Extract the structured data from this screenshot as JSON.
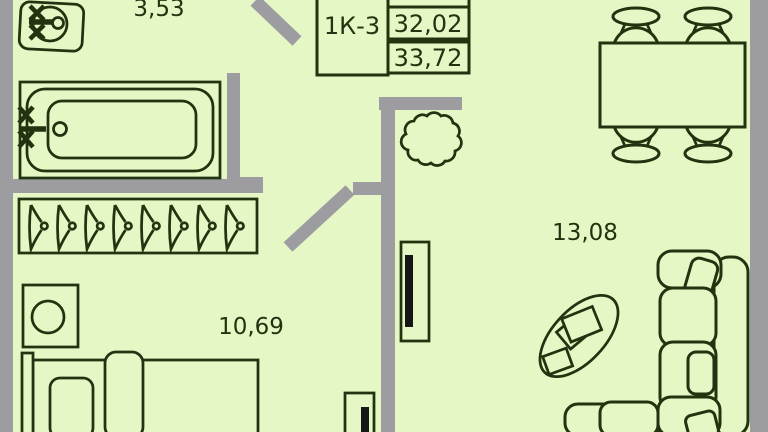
{
  "plan": {
    "unit_table": {
      "unit_type": "1К-3",
      "value_top": "32,02",
      "value_bottom": "33,72"
    },
    "rooms": {
      "bathroom": {
        "area": "3,53"
      },
      "bedroom": {
        "area": "10,69"
      },
      "living_room": {
        "area": "13,08"
      }
    },
    "colors": {
      "floor": "#e6f7c6",
      "wall": "#9d9da1",
      "line": "#22330f",
      "shaft": "#161616"
    },
    "icons": [
      "sink-icon",
      "bathtub-icon",
      "faucet-icon",
      "hanger-icon",
      "stool-icon",
      "bed-icon",
      "door-swing-icon",
      "vent-shaft-icon",
      "plant-icon",
      "dining-table-icon",
      "chair-icon",
      "sofa-icon",
      "coffee-table-icon"
    ]
  }
}
